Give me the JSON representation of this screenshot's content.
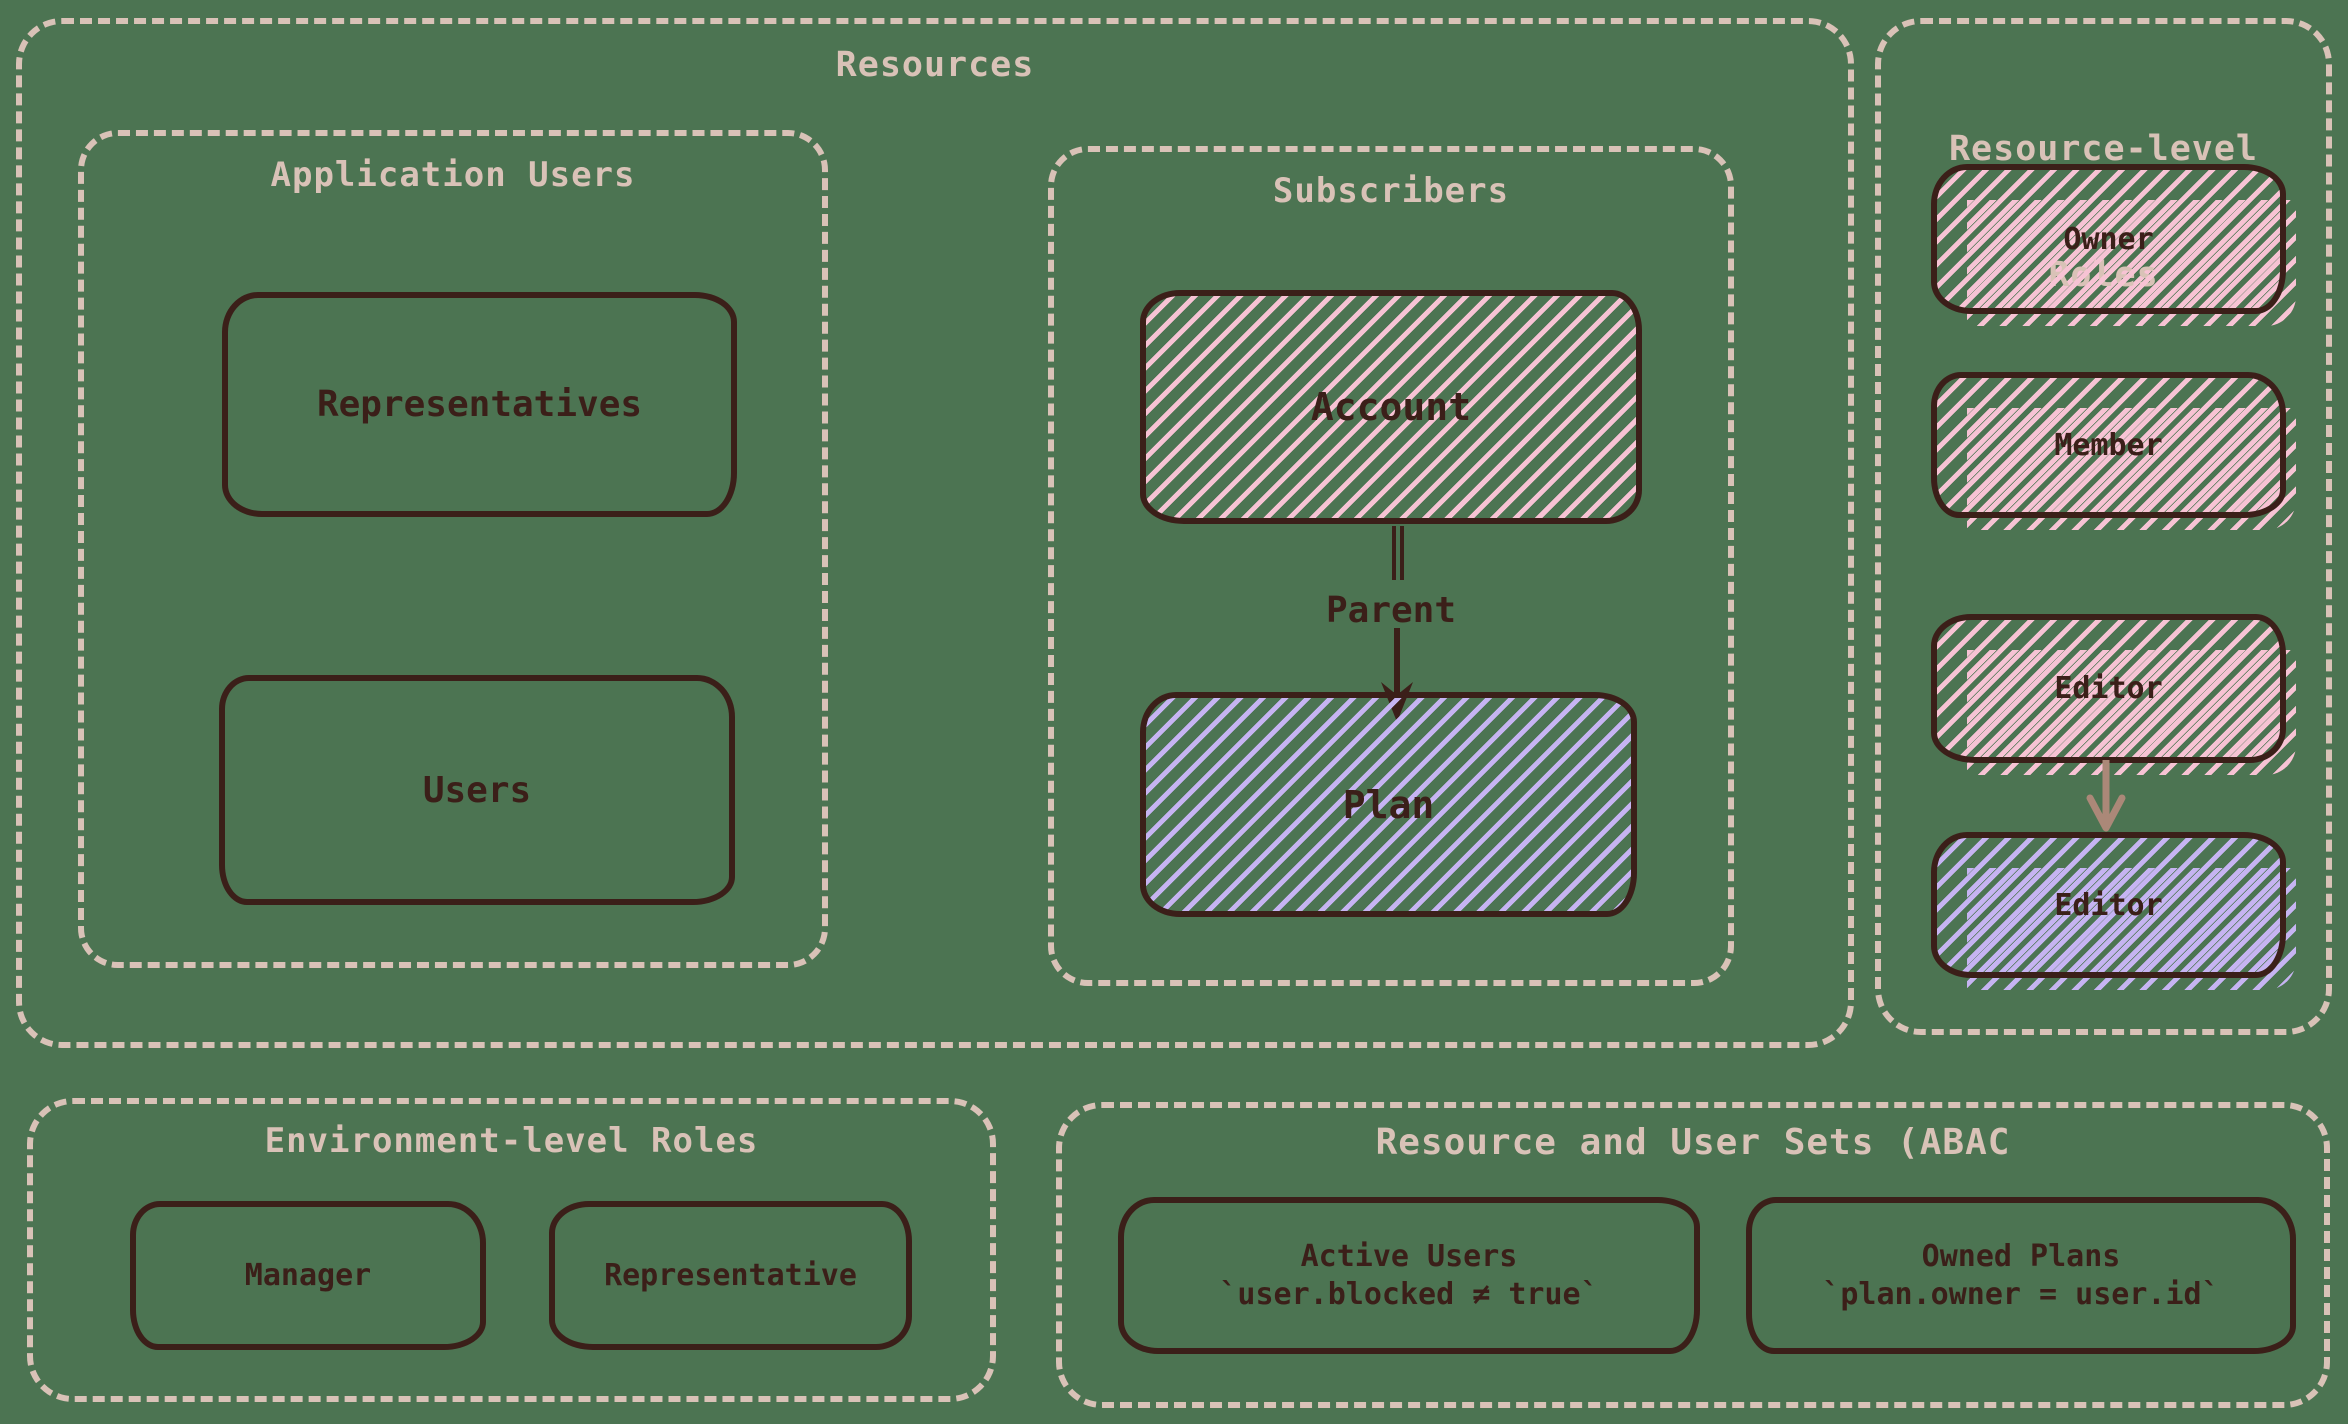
{
  "colors": {
    "background": "#4c7452",
    "outline_cream": "#d9c2b7",
    "ink_brown": "#3b1f19",
    "hatch_pink": "#f7c3d4",
    "hatch_lavender": "#c6b4f2",
    "arrow_rose": "#ab8878"
  },
  "resources": {
    "title": "Resources"
  },
  "application_users": {
    "title": "Application Users",
    "boxes": [
      {
        "label": "Representatives"
      },
      {
        "label": "Users"
      }
    ]
  },
  "subscribers": {
    "title": "Subscribers",
    "account_label": "Account",
    "parent_label": "Parent",
    "plan_label": "Plan"
  },
  "resource_level_roles": {
    "title_line1": "Resource-level",
    "title_line2": "Roles",
    "boxes": [
      {
        "label": "Owner",
        "hatch": "pink"
      },
      {
        "label": "Member",
        "hatch": "pink"
      },
      {
        "label": "Editor",
        "hatch": "pink"
      },
      {
        "label": "Editor",
        "hatch": "lavender"
      }
    ]
  },
  "environment_level_roles": {
    "title": "Environment-level Roles",
    "boxes": [
      {
        "label": "Manager"
      },
      {
        "label": "Representative"
      }
    ]
  },
  "resource_user_sets": {
    "title": "Resource and User Sets (ABAC",
    "boxes": [
      {
        "name": "Active Users",
        "rule": "`user.blocked ≠ true`"
      },
      {
        "name": "Owned Plans",
        "rule": "`plan.owner = user.id`"
      }
    ]
  }
}
